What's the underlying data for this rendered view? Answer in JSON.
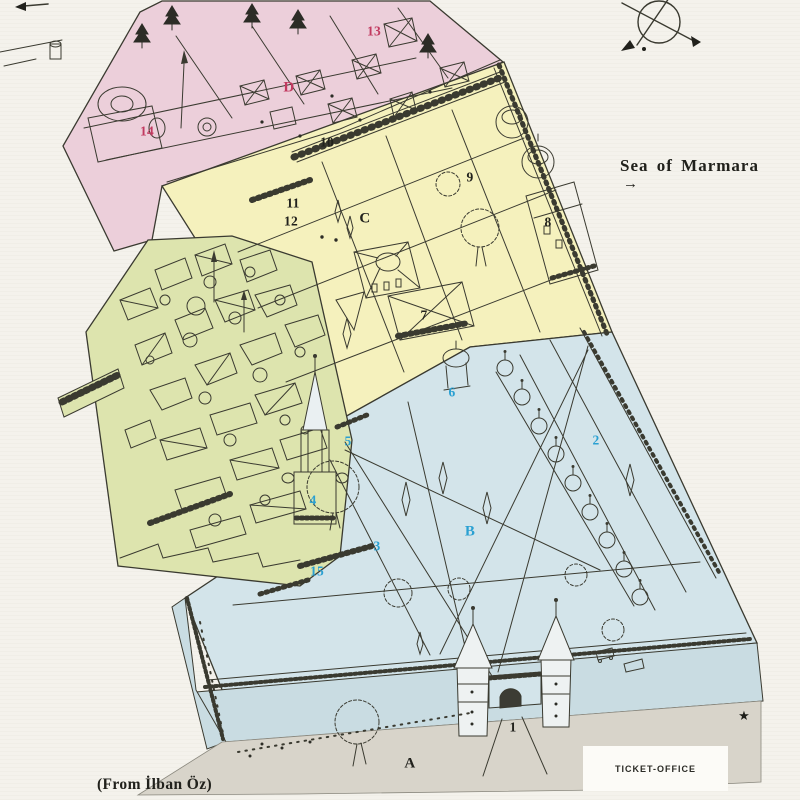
{
  "map_title": "Topkapi Palace isometric plan",
  "sea": {
    "label": "Sea of Marmara",
    "arrow": "→"
  },
  "attribution": {
    "label": "(From İlban Öz)"
  },
  "ticket_office": {
    "label": "TICKET-OFFICE"
  },
  "star": {
    "glyph": "★"
  },
  "compass": {
    "icon": "compass-rose"
  },
  "palette": {
    "background": "#f4f2ec",
    "line": "#3a3a30",
    "zone_first_court_pink": "#eccfda",
    "zone_third_court_yellow": "#f5f1bd",
    "zone_harem_green": "#dde4ae",
    "zone_second_court_blue": "#d3e4ea",
    "zone_foreground_gray": "#d8d4ca",
    "wall_face": "#c9dce2",
    "marker_red": "#c23a60",
    "marker_cyan": "#2aa0d2",
    "marker_black": "#21211c"
  },
  "markers": [
    {
      "label": "13",
      "tone": "red"
    },
    {
      "label": "D",
      "tone": "red"
    },
    {
      "label": "14",
      "tone": "red"
    },
    {
      "label": "10",
      "tone": "black"
    },
    {
      "label": "9",
      "tone": "black"
    },
    {
      "label": "11",
      "tone": "black"
    },
    {
      "label": "C",
      "tone": "black"
    },
    {
      "label": "12",
      "tone": "black"
    },
    {
      "label": "8",
      "tone": "black"
    },
    {
      "label": "7",
      "tone": "black"
    },
    {
      "label": "6",
      "tone": "cyan"
    },
    {
      "label": "5",
      "tone": "cyan"
    },
    {
      "label": "2",
      "tone": "cyan"
    },
    {
      "label": "4",
      "tone": "cyan"
    },
    {
      "label": "B",
      "tone": "cyan"
    },
    {
      "label": "3",
      "tone": "cyan"
    },
    {
      "label": "15",
      "tone": "cyan"
    },
    {
      "label": "1",
      "tone": "black"
    },
    {
      "label": "A",
      "tone": "black"
    }
  ]
}
